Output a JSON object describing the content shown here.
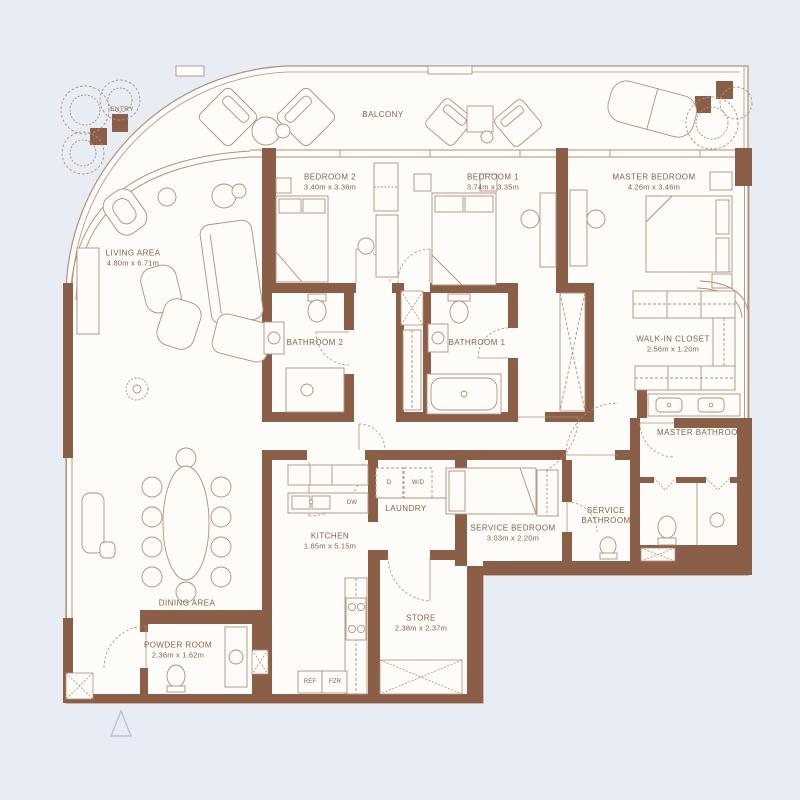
{
  "title": "Apartment Floor Plan",
  "colors": {
    "background": "#e8edf5",
    "floor": "#fdfcf8",
    "wall": "#8b5e47",
    "line": "#b3907a",
    "text": "#8b5e47",
    "north_arrow": "#b9c3d6"
  },
  "plan": {
    "outdoor": {
      "balcony": "BALCONY",
      "entry": "ENTRY"
    },
    "rooms": [
      {
        "id": "living-area",
        "label": "LIVING AREA",
        "dims": "4.80m x 6.71m"
      },
      {
        "id": "bedroom-2",
        "label": "BEDROOM 2",
        "dims": "3.40m x 3.36m"
      },
      {
        "id": "bedroom-1",
        "label": "BEDROOM 1",
        "dims": "3.74m x 3.35m"
      },
      {
        "id": "master-bedroom",
        "label": "MASTER BEDROOM",
        "dims": "4.26m x 3.46m"
      },
      {
        "id": "bathroom-2",
        "label": "BATHROOM 2",
        "dims": ""
      },
      {
        "id": "bathroom-1",
        "label": "BATHROOM 1",
        "dims": ""
      },
      {
        "id": "walk-in-closet",
        "label": "WALK-IN CLOSET",
        "dims": "2.56m x 1.20m"
      },
      {
        "id": "master-bathroom",
        "label": "MASTER BATHROOM",
        "dims": ""
      },
      {
        "id": "kitchen",
        "label": "KITCHEN",
        "dims": "1.85m x 5.15m"
      },
      {
        "id": "laundry",
        "label": "LAUNDRY",
        "dims": ""
      },
      {
        "id": "service-bedroom",
        "label": "SERVICE BEDROOM",
        "dims": "3.03m x 2.20m"
      },
      {
        "id": "service-bathroom",
        "label": "SERVICE BATHROOM",
        "dims": ""
      },
      {
        "id": "dining-area",
        "label": "DINING AREA",
        "dims": "2.90m x 3.83m"
      },
      {
        "id": "powder-room",
        "label": "POWDER ROOM",
        "dims": "2.36m x 1.62m"
      },
      {
        "id": "store",
        "label": "STORE",
        "dims": "2.38m x 2.37m"
      }
    ],
    "appliances": {
      "ref": "REF",
      "fzr": "FZR",
      "dw": "DW",
      "dryer": "D",
      "washer_dryer": "W/D"
    }
  }
}
